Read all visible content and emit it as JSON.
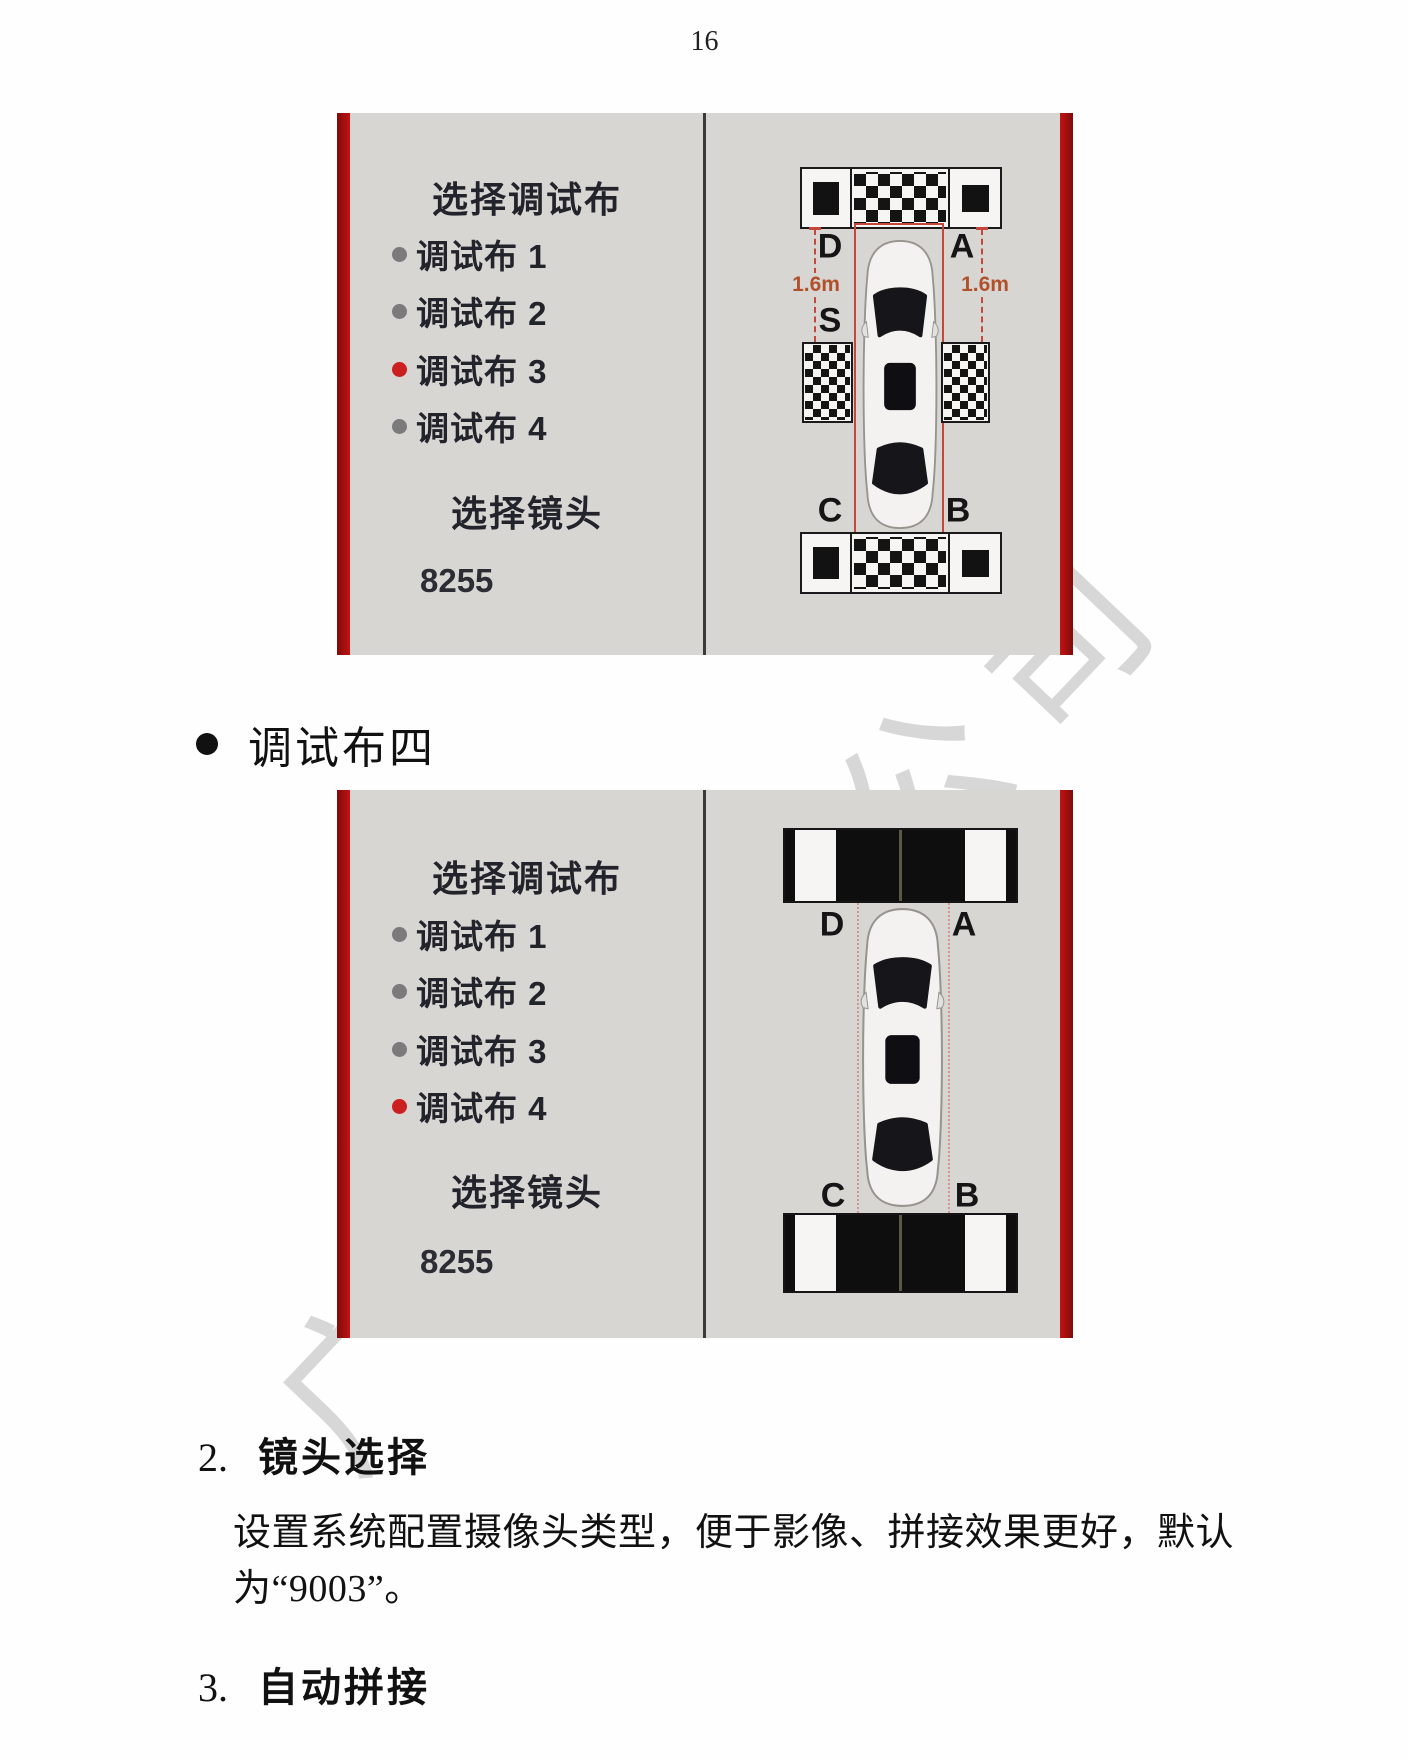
{
  "page": {
    "number": "16"
  },
  "watermark": {
    "text": "广州有限公司"
  },
  "screenshots": [
    {
      "panel": {
        "title": "选择调试布",
        "options": [
          {
            "label": "调试布 1",
            "selected": false
          },
          {
            "label": "调试布 2",
            "selected": false
          },
          {
            "label": "调试布 3",
            "selected": true
          },
          {
            "label": "调试布 4",
            "selected": false
          }
        ],
        "lens_title": "选择镜头",
        "lens_value": "8255"
      },
      "diagram": {
        "corner_top_left": "D",
        "corner_top_right": "A",
        "side_left": "S",
        "corner_bottom_left": "C",
        "corner_bottom_right": "B",
        "measure_left": "1.6m",
        "measure_right": "1.6m"
      }
    },
    {
      "panel": {
        "title": "选择调试布",
        "options": [
          {
            "label": "调试布 1",
            "selected": false
          },
          {
            "label": "调试布 2",
            "selected": false
          },
          {
            "label": "调试布 3",
            "selected": false
          },
          {
            "label": "调试布 4",
            "selected": true
          }
        ],
        "lens_title": "选择镜头",
        "lens_value": "8255"
      },
      "diagram": {
        "corner_top_left": "D",
        "corner_top_right": "A",
        "corner_bottom_left": "C",
        "corner_bottom_right": "B"
      }
    }
  ],
  "bullet": {
    "label": "调试布四"
  },
  "sections": [
    {
      "number": "2.",
      "title": "镜头选择",
      "body": [
        "设置系统配置摄像头类型，便于影像、拼接效果更好，默认",
        "为“9003”。"
      ]
    },
    {
      "number": "3.",
      "title": "自动拼接"
    }
  ],
  "colors": {
    "accent_red": "#b90f0f",
    "screenshot_bg": "#d8d6d3",
    "selected_dot": "#cc1f1f",
    "unselected_dot": "#7b7b7b",
    "measure_text": "#b0512b"
  }
}
